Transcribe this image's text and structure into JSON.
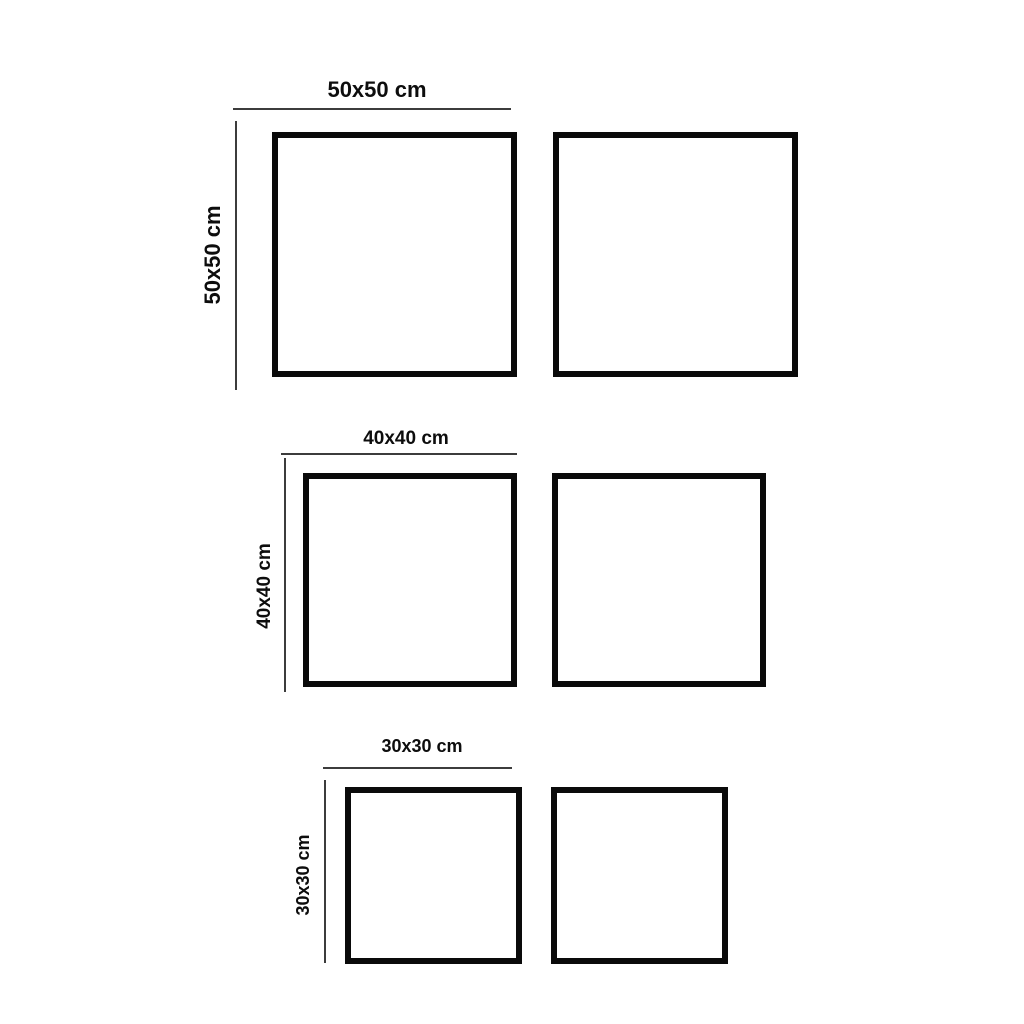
{
  "diagram": {
    "description": "Square frame size diagram with three size pairs",
    "background_color": "#ffffff",
    "frame_border_color": "#0a0a0a",
    "dimension_line_color": "#3c3c3c",
    "label_color": "#0d0d0d",
    "rows": [
      {
        "size": "50x50",
        "top_label": "50x50 cm",
        "side_label": "50x50 cm",
        "square_count": 2
      },
      {
        "size": "40x40",
        "top_label": "40x40 cm",
        "side_label": "40x40 cm",
        "square_count": 2
      },
      {
        "size": "30x30",
        "top_label": "30x30 cm",
        "side_label": "30x30 cm",
        "square_count": 2
      }
    ]
  }
}
